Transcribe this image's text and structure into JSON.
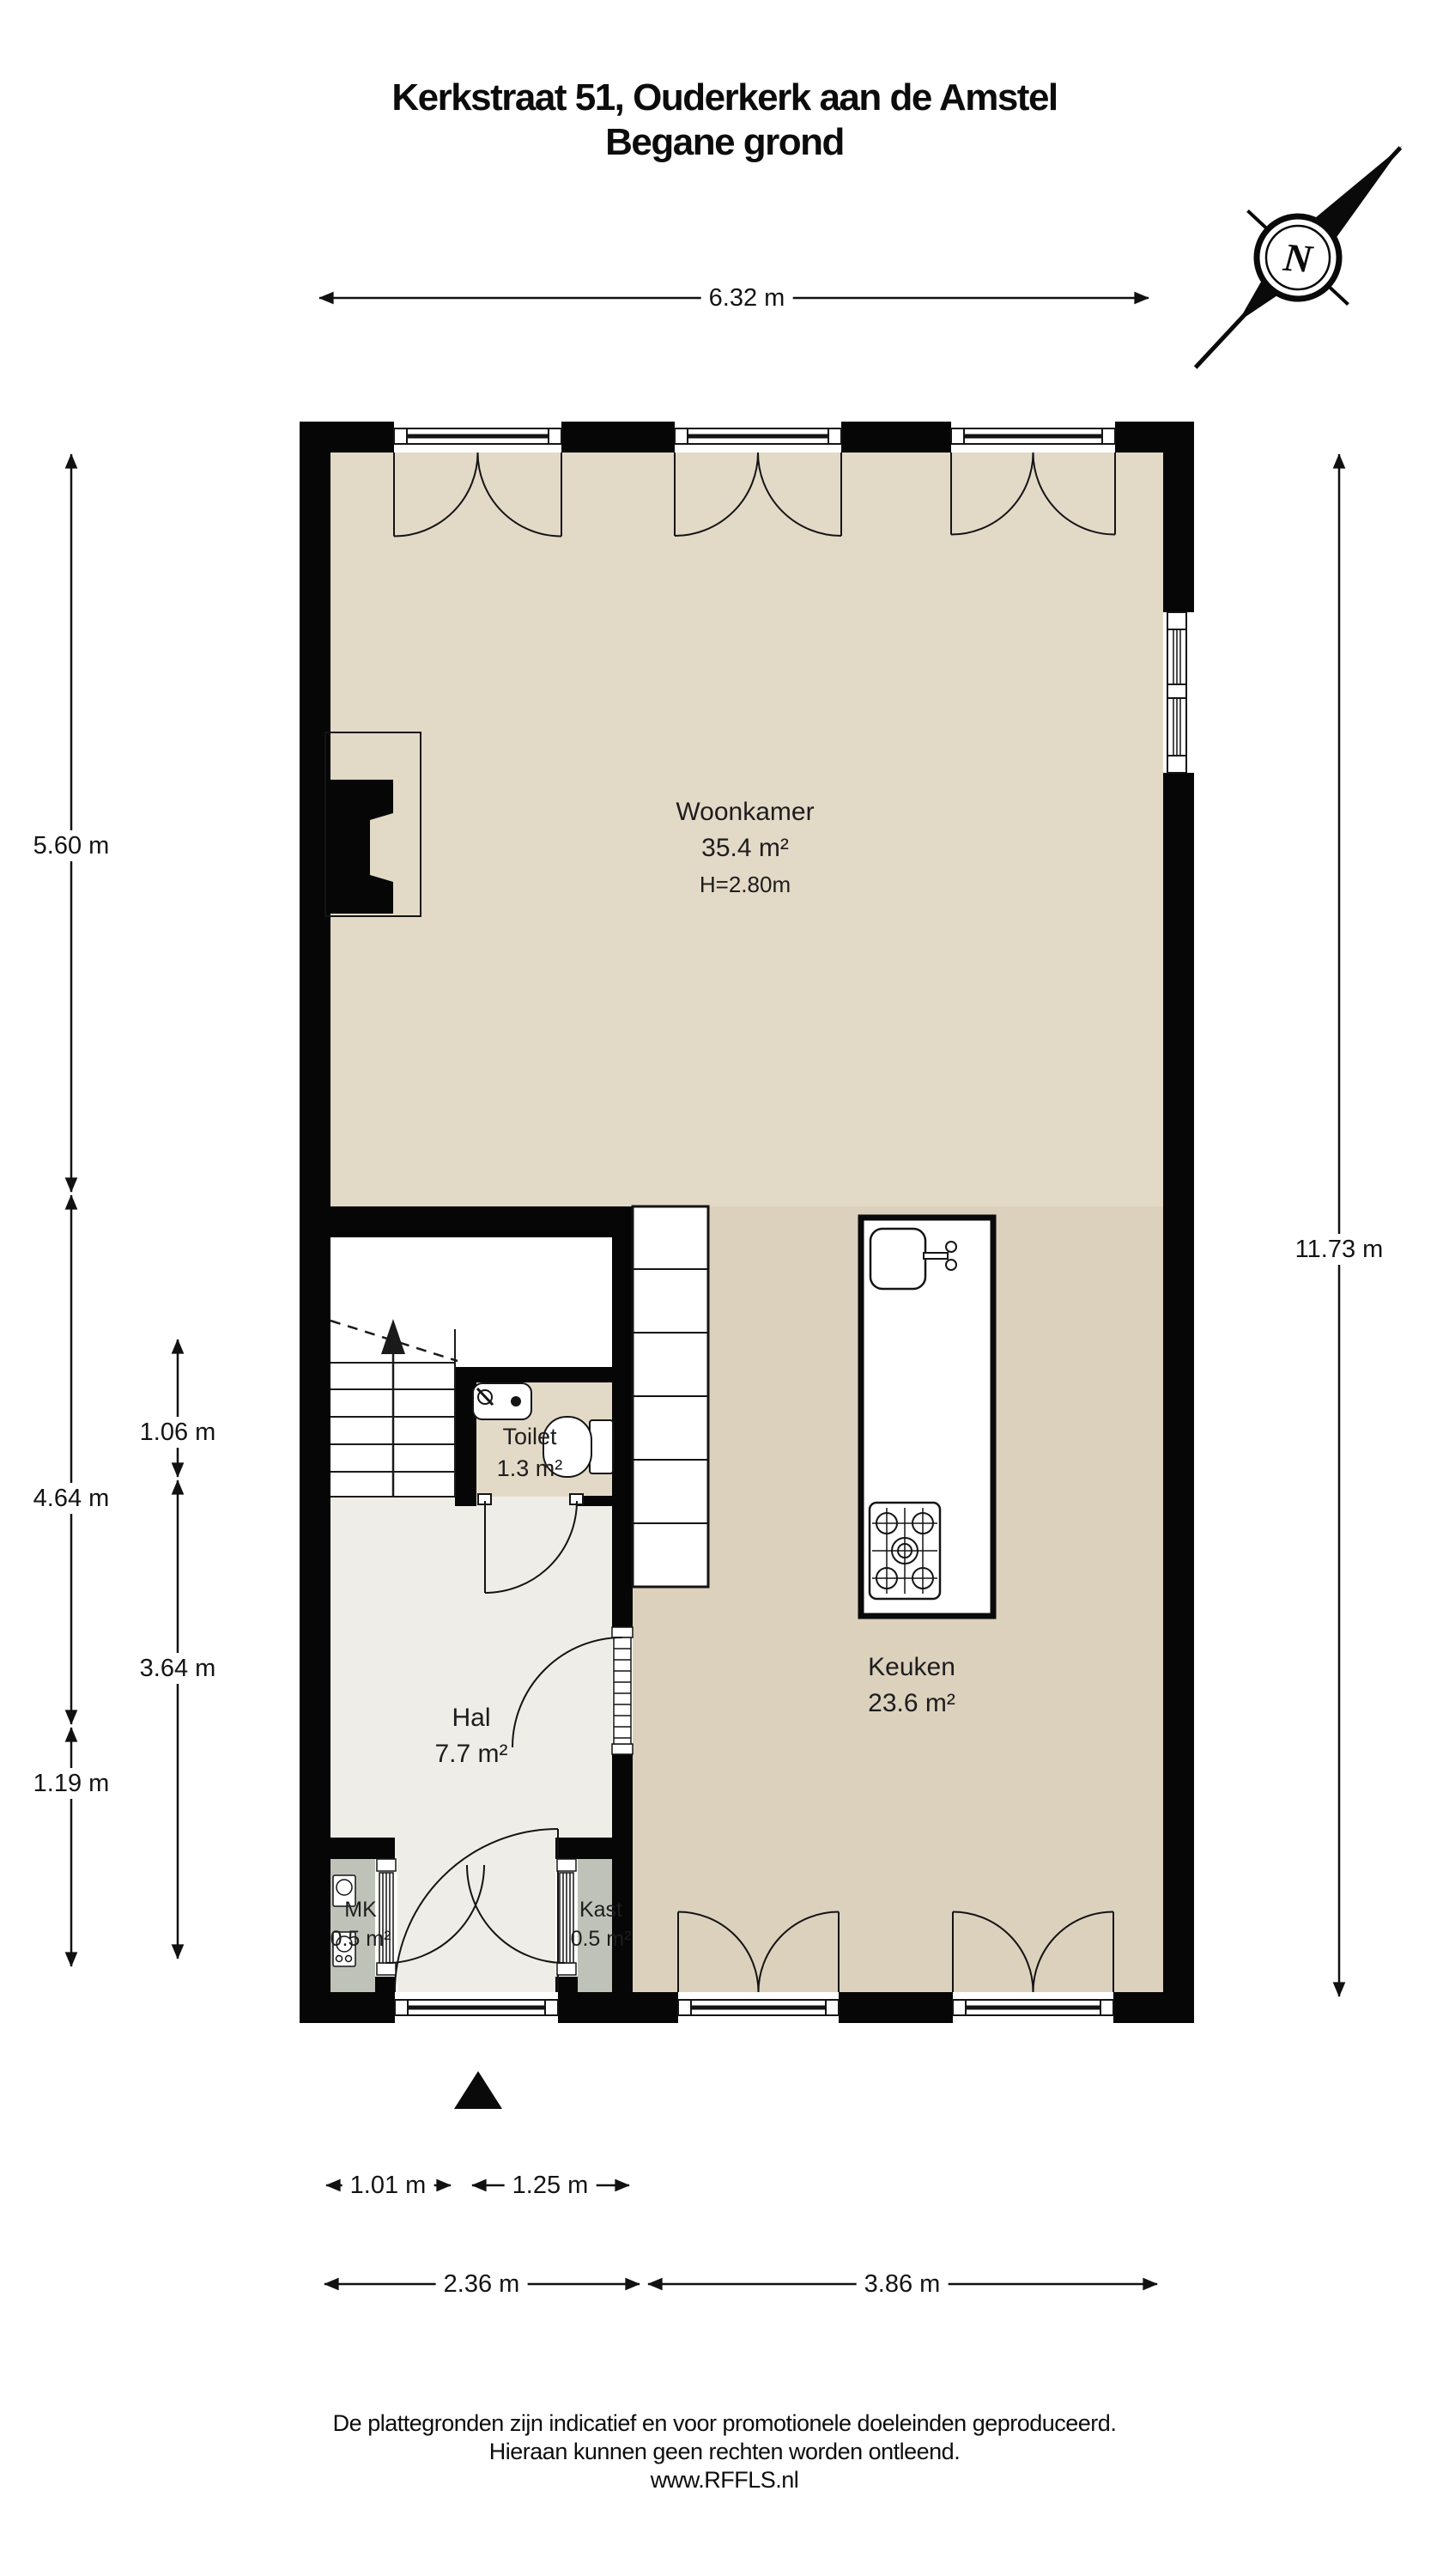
{
  "page": {
    "title_line1": "Kerkstraat 51, Ouderkerk aan de Amstel",
    "title_line2": "Begane grond"
  },
  "compass": {
    "label": "N"
  },
  "rooms": {
    "woonkamer": {
      "name": "Woonkamer",
      "area": "35.4 m²",
      "ceiling_height": "H=2.80m"
    },
    "toilet": {
      "name": "Toilet",
      "area": "1.3 m²"
    },
    "keuken": {
      "name": "Keuken",
      "area": "23.6 m²"
    },
    "hal": {
      "name": "Hal",
      "area": "7.7 m²"
    },
    "mk": {
      "name": "MK",
      "area": "0.5 m²"
    },
    "kast": {
      "name": "Kast",
      "area": "0.5 m²"
    }
  },
  "dimensions": {
    "width_total": "6.32 m",
    "left_upper": "5.60 m",
    "left_middle": "4.64 m",
    "left_lower": "1.19 m",
    "inner_upper": "1.06 m",
    "inner_lower": "3.64 m",
    "right_total": "11.73 m",
    "bottom_door_left": "1.01 m",
    "bottom_door_right": "1.25 m",
    "bottom_left": "2.36 m",
    "bottom_right": "3.86 m"
  },
  "footer": {
    "line1": "De plattegronden zijn indicatief en voor promotionele doeleinden geproduceerd.",
    "line2": "Hieraan kunnen geen rechten worden ontleend.",
    "line3": "www.RFFLS.nl"
  },
  "colors": {
    "wall": "#060606",
    "floor_living": "#e3d9c7",
    "floor_kitchen": "#dcd1bd",
    "floor_hall": "#efede7",
    "floor_closet": "#bfc2b9",
    "background": "#ffffff"
  }
}
